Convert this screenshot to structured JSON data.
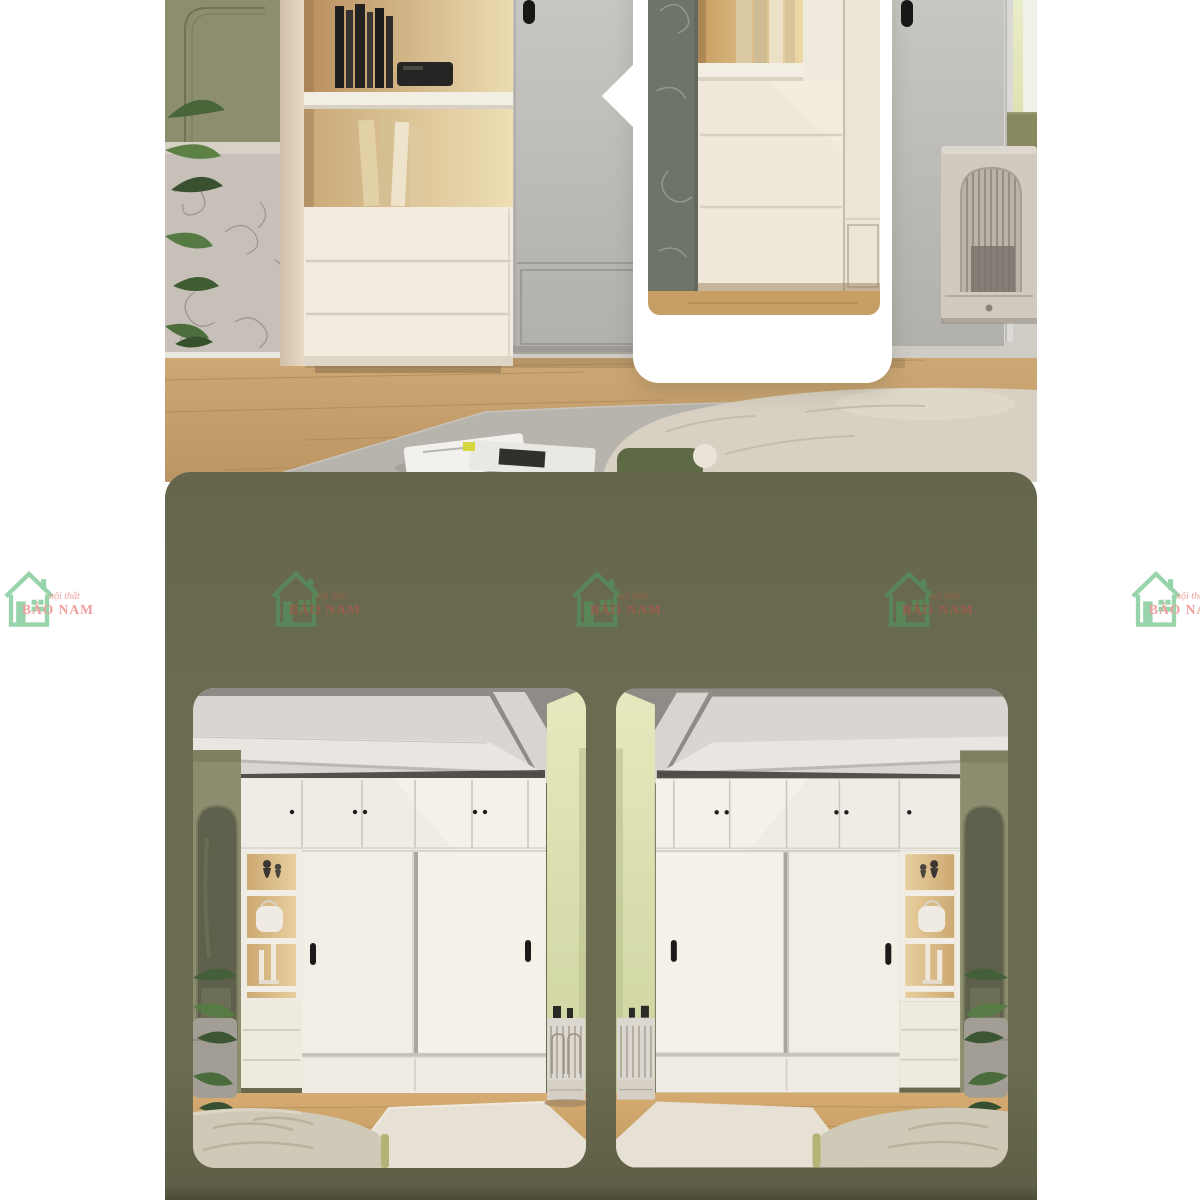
{
  "brand": {
    "logo_icon": "house-icon",
    "tagline": "nội thất",
    "name": "BẢO NAM"
  },
  "theme": {
    "page_bg": "#ffffff",
    "panel_olive": "#6a6b50",
    "panel_olive_deep": "#5c5d44",
    "callout_bg": "#ffffff",
    "logo_green": "#43b269",
    "logo_red": "#e1504a"
  },
  "gallery": {
    "top_photo": "bedroom-cream-cabinet-photo",
    "callout": "drawer-detail-zoom-callout",
    "bottom_left_photo": "white-sliding-wardrobe-photo",
    "bottom_right_photo": "white-sliding-wardrobe-photo-mirrored"
  },
  "watermarks": [
    {
      "placement": "left-margin"
    },
    {
      "placement": "panel-left"
    },
    {
      "placement": "panel-center"
    },
    {
      "placement": "panel-right"
    },
    {
      "placement": "right-margin"
    }
  ]
}
